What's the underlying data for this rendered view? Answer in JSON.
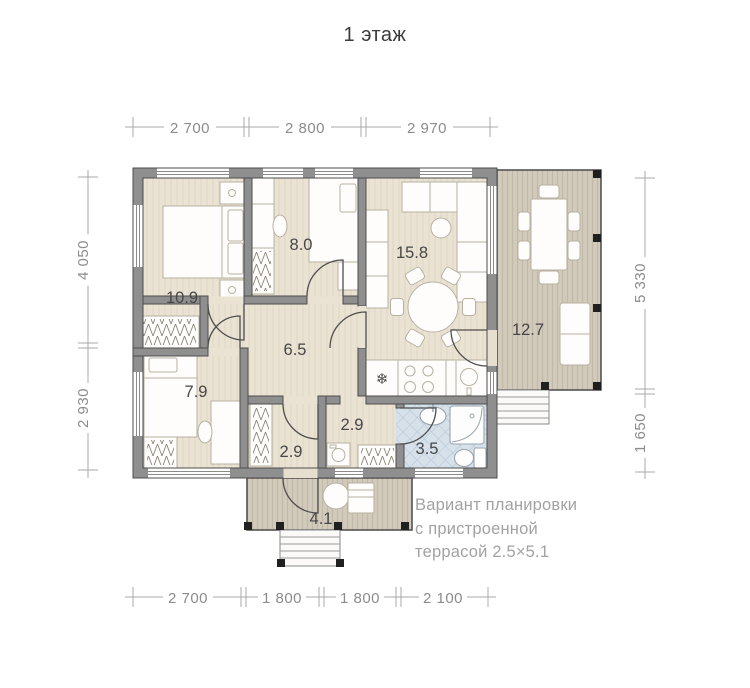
{
  "title": "1 этаж",
  "plan": {
    "rooms": [
      {
        "id": "bedroom-1",
        "area": "10.9"
      },
      {
        "id": "bedroom-2",
        "area": "8.0"
      },
      {
        "id": "living-kitchen",
        "area": "15.8"
      },
      {
        "id": "hall",
        "area": "6.5"
      },
      {
        "id": "bedroom-3",
        "area": "7.9"
      },
      {
        "id": "corridor",
        "area": "2.9"
      },
      {
        "id": "laundry",
        "area": "2.9"
      },
      {
        "id": "bathroom",
        "area": "3.5"
      },
      {
        "id": "terrace",
        "area": "12.7"
      },
      {
        "id": "porch",
        "area": "4.1"
      }
    ],
    "dimensions": {
      "top": [
        "2 700",
        "2 800",
        "2 970"
      ],
      "bottom": [
        "2 700",
        "1 800",
        "1 800",
        "2 100"
      ],
      "left": [
        "4 050",
        "2 930"
      ],
      "right": [
        "5 330",
        "1 650"
      ]
    }
  },
  "annotation": {
    "lines": [
      "Вариант планировки",
      "с пристроенной",
      "террасой 2.5×5.1"
    ]
  },
  "colors": {
    "wall": "#8f8f8f",
    "wall_outline": "#4d4d4d",
    "floor": "#eae3d3",
    "deck": "#d2cabb",
    "bath_tile": "#d6e1ea",
    "dimension": "#8c8c8c",
    "room_label": "#474747",
    "annotation_text": "#a2a2a2"
  }
}
